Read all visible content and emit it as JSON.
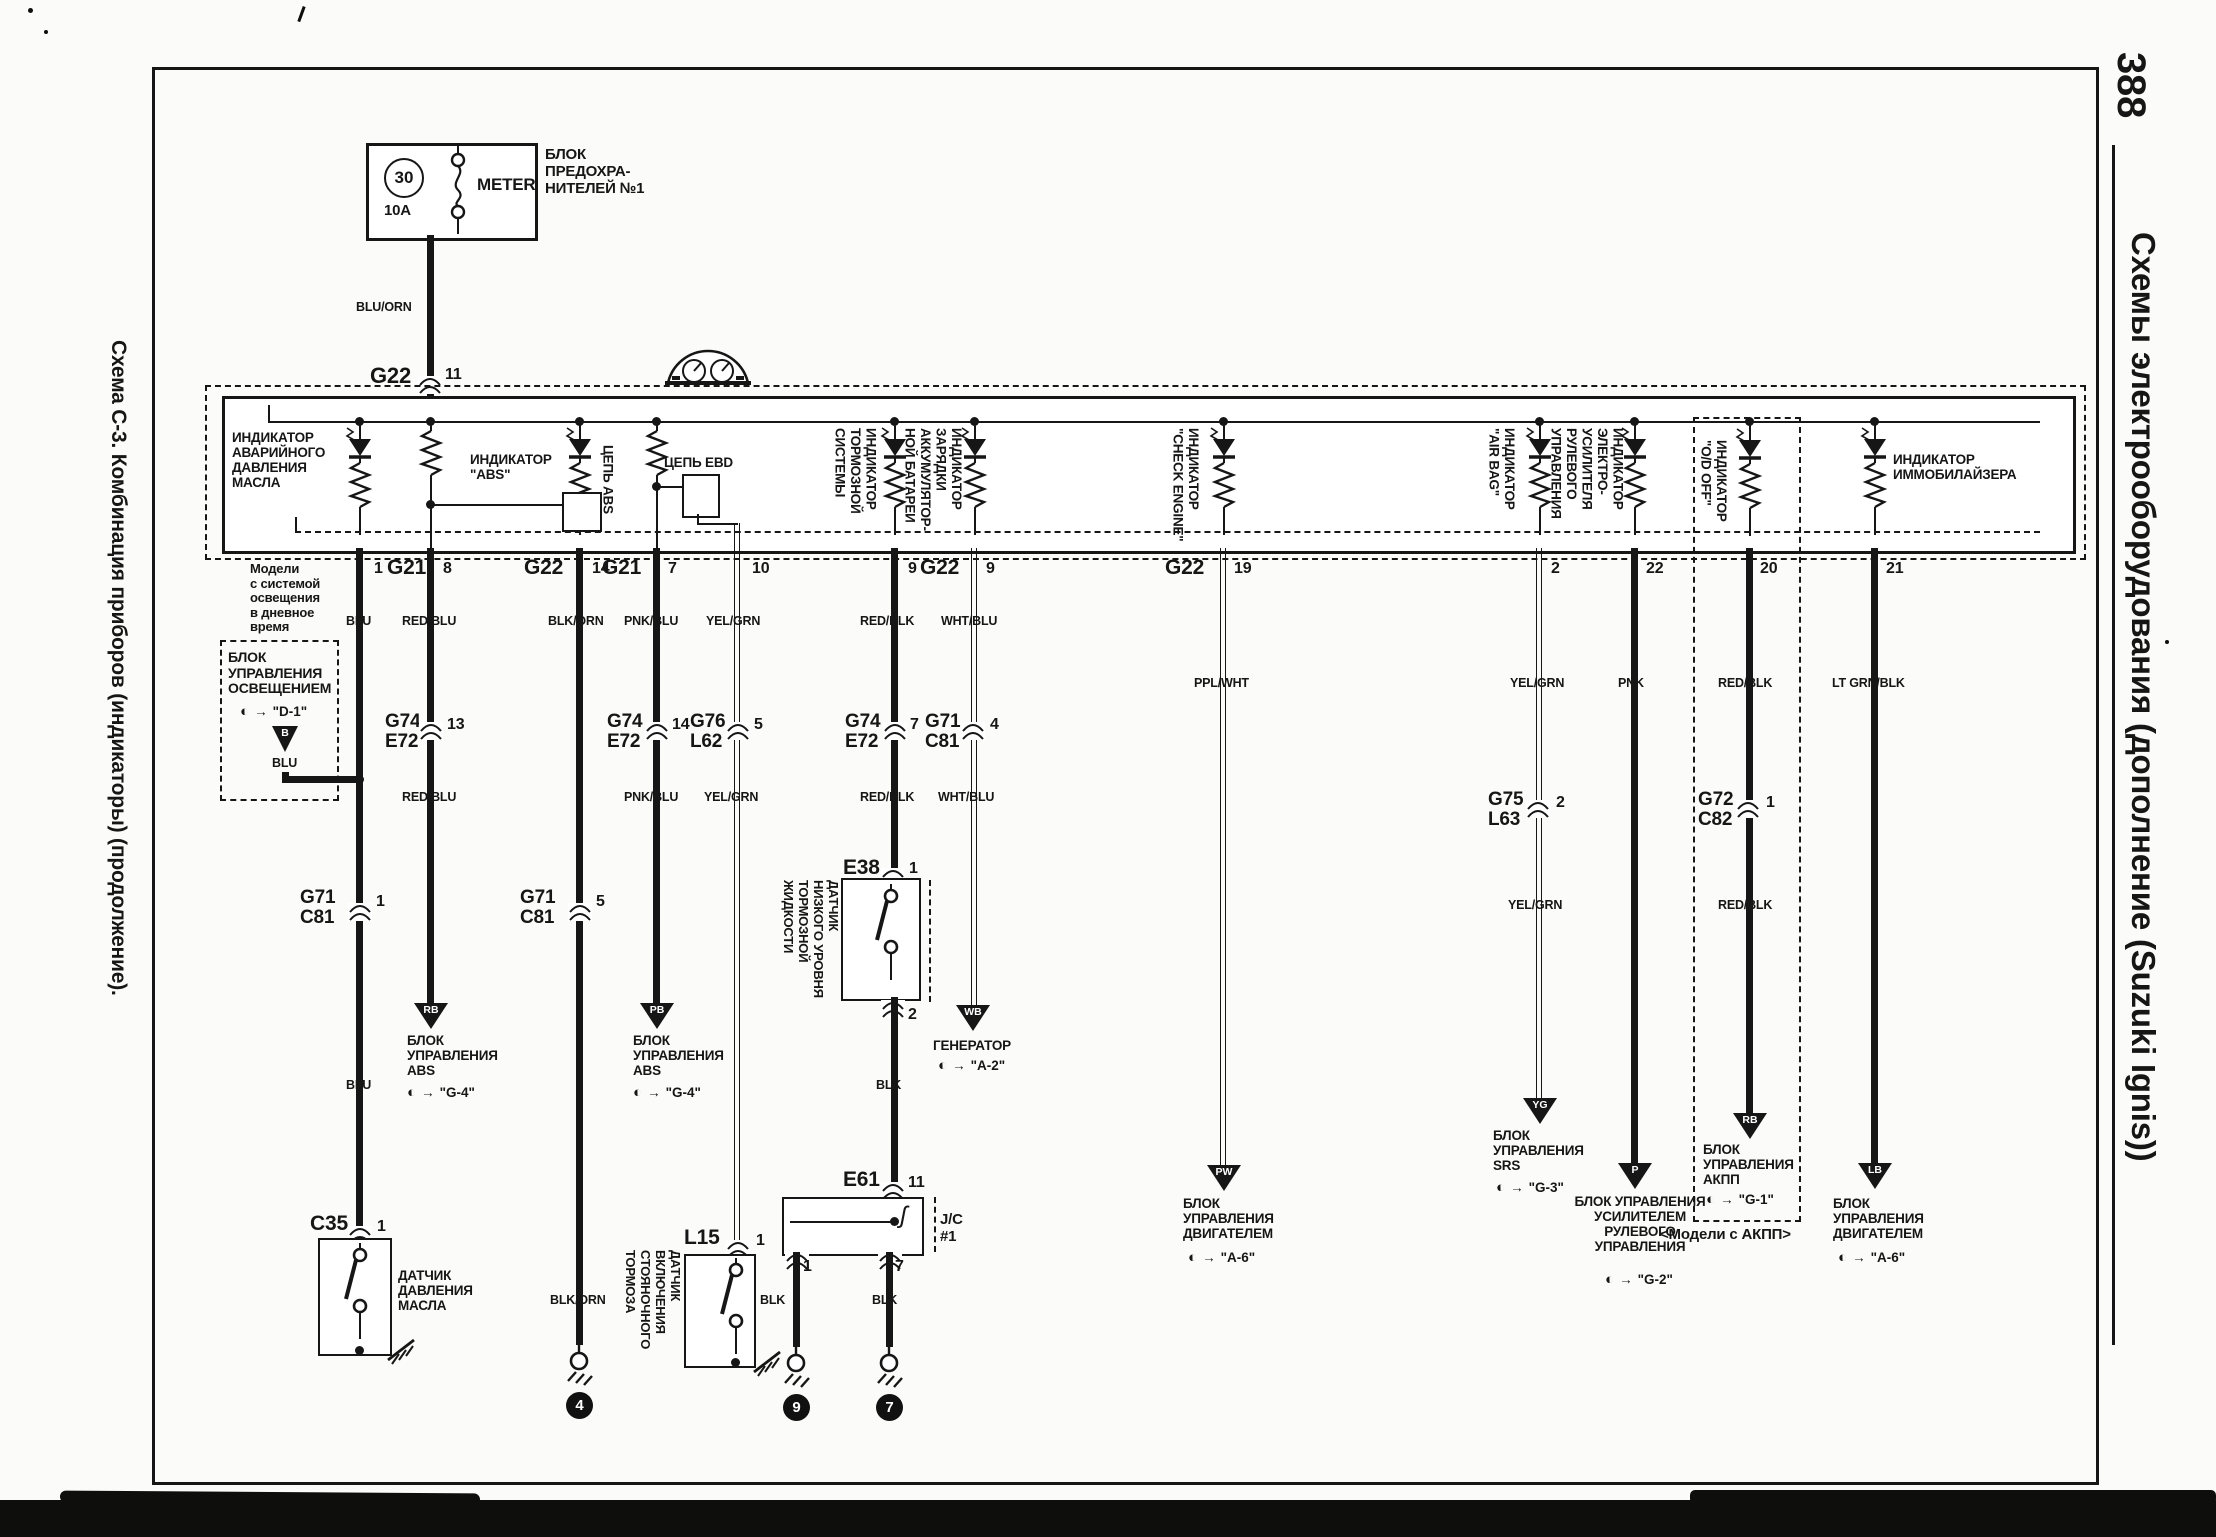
{
  "page": {
    "number": "388",
    "right_title": "Схемы электрооборудования (дополнение (Suzuki Ignis))",
    "left_title": "Схема С-3. Комбинация приборов (индикаторы) (продолжение)."
  },
  "fuse_block": {
    "fuse_number": "30",
    "rating": "10A",
    "fuse_name": "METER",
    "label": "БЛОК\nПРЕДОХРА-\nНИТЕЛЕЙ №1"
  },
  "feed": {
    "wire": "BLU/ORN",
    "conn": "G22",
    "pin": "11"
  },
  "indicators": {
    "oil": "ИНДИКАТОР\nАВАРИЙНОГО\nДАВЛЕНИЯ\nМАСЛА",
    "abs": "ИНДИКАТОР\n\"ABS\"",
    "abs_circuit": "ЦЕПЬ ABS",
    "ebd_circuit": "ЦЕПЬ EBD",
    "brake": "ИНДИКАТОР\nТОРМОЗНОЙ\nСИСТЕМЫ",
    "charge": "ИНДИКАТОР\nЗАРЯДКИ\nАККУМУЛЯТОР-\nНОЙ БАТАРЕИ",
    "check_engine": "ИНДИКАТОР\n\"CHECK ENGINE\"",
    "airbag": "ИНДИКАТОР\n\"AIR BAG\"",
    "eps": "ИНДИКАТОР\nЭЛЕКТРО-\nУСИЛИТЕЛЯ\nРУЛЕВОГО\nУПРАВЛЕНИЯ",
    "od_off": "ИНДИКАТОР\n\"O/D OFF\"",
    "immobilizer": "ИНДИКАТОР\nИММОБИЛАЙЗЕРА"
  },
  "connectors": {
    "g21": "G21",
    "g22": "G22",
    "g74": "G74",
    "e72": "E72",
    "g76": "G76",
    "l62": "L62",
    "g71": "G71",
    "c81": "C81",
    "g75": "G75",
    "l63": "L63",
    "g72": "G72",
    "c82": "C82",
    "c35": "C35",
    "l15": "L15",
    "e38": "E38",
    "e61": "E61",
    "jc": "J/C\n#1"
  },
  "pins": {
    "p1": "1",
    "p2": "2",
    "p4": "4",
    "p5": "5",
    "p7": "7",
    "p8": "8",
    "p9": "9",
    "p10": "10",
    "p11": "11",
    "p13": "13",
    "p14": "14",
    "p19": "19",
    "p20": "20",
    "p21": "21",
    "p22": "22"
  },
  "wires": {
    "blu": "BLU",
    "redblu": "RED/BLU",
    "blkorn": "BLK/ORN",
    "pnkblu": "PNK/BLU",
    "yelgrn": "YEL/GRN",
    "redblk": "RED/BLK",
    "whtblu": "WHT/BLU",
    "pplwht": "PPL/WHT",
    "pnk": "PNK",
    "ltgrnblk": "LT GRN/BLK",
    "blk": "BLK"
  },
  "notes": {
    "drl": "Модели\nс системой\nосвещения\nв дневное\nвремя",
    "at_models": "<Модели с АКПП>"
  },
  "light_ctrl": {
    "title": "БЛОК\nУПРАВЛЕНИЯ\nОСВЕЩЕНИЕМ",
    "ref": "\"D-1\"",
    "code": "B",
    "wire": "BLU"
  },
  "devices": {
    "oil_sensor": "ДАТЧИК\nДАВЛЕНИЯ\nМАСЛА",
    "park_brake": "ДАТЧИК\nВКЛЮЧЕНИЯ\nСТОЯНОЧНОГО\nТОРМОЗА",
    "brake_fluid": "ДАТЧИК\nНИЗКОГО УРОВНЯ\nТОРМОЗНОЙ\nЖИДКОСТИ"
  },
  "destinations": {
    "abs1": {
      "code": "RB",
      "title": "БЛОК\nУПРАВЛЕНИЯ\nABS",
      "ref": "\"G-4\""
    },
    "abs2": {
      "code": "PB",
      "title": "БЛОК\nУПРАВЛЕНИЯ\nABS",
      "ref": "\"G-4\""
    },
    "generator": {
      "code": "WB",
      "title": "ГЕНЕРАТОР",
      "ref": "\"A-2\""
    },
    "ecm1": {
      "code": "PW",
      "title": "БЛОК\nУПРАВЛЕНИЯ\nДВИГАТЕЛЕМ",
      "ref": "\"A-6\""
    },
    "srs": {
      "code": "YG",
      "title": "БЛОК\nУПРАВЛЕНИЯ\nSRS",
      "ref": "\"G-3\""
    },
    "eps": {
      "code": "P",
      "title": "БЛОК УПРАВЛЕНИЯ\nУСИЛИТЕЛЕМ\nРУЛЕВОГО\nУПРАВЛЕНИЯ",
      "ref": "\"G-2\""
    },
    "akpp": {
      "code": "RB",
      "title": "БЛОК\nУПРАВЛЕНИЯ\nАКПП",
      "ref": "\"G-1\""
    },
    "ecm2": {
      "code": "LB",
      "title": "БЛОК\nУПРАВЛЕНИЯ\nДВИГАТЕЛЕМ",
      "ref": "\"A-6\""
    }
  },
  "grounds": {
    "n4": "4",
    "n9": "9",
    "n7": "7"
  }
}
